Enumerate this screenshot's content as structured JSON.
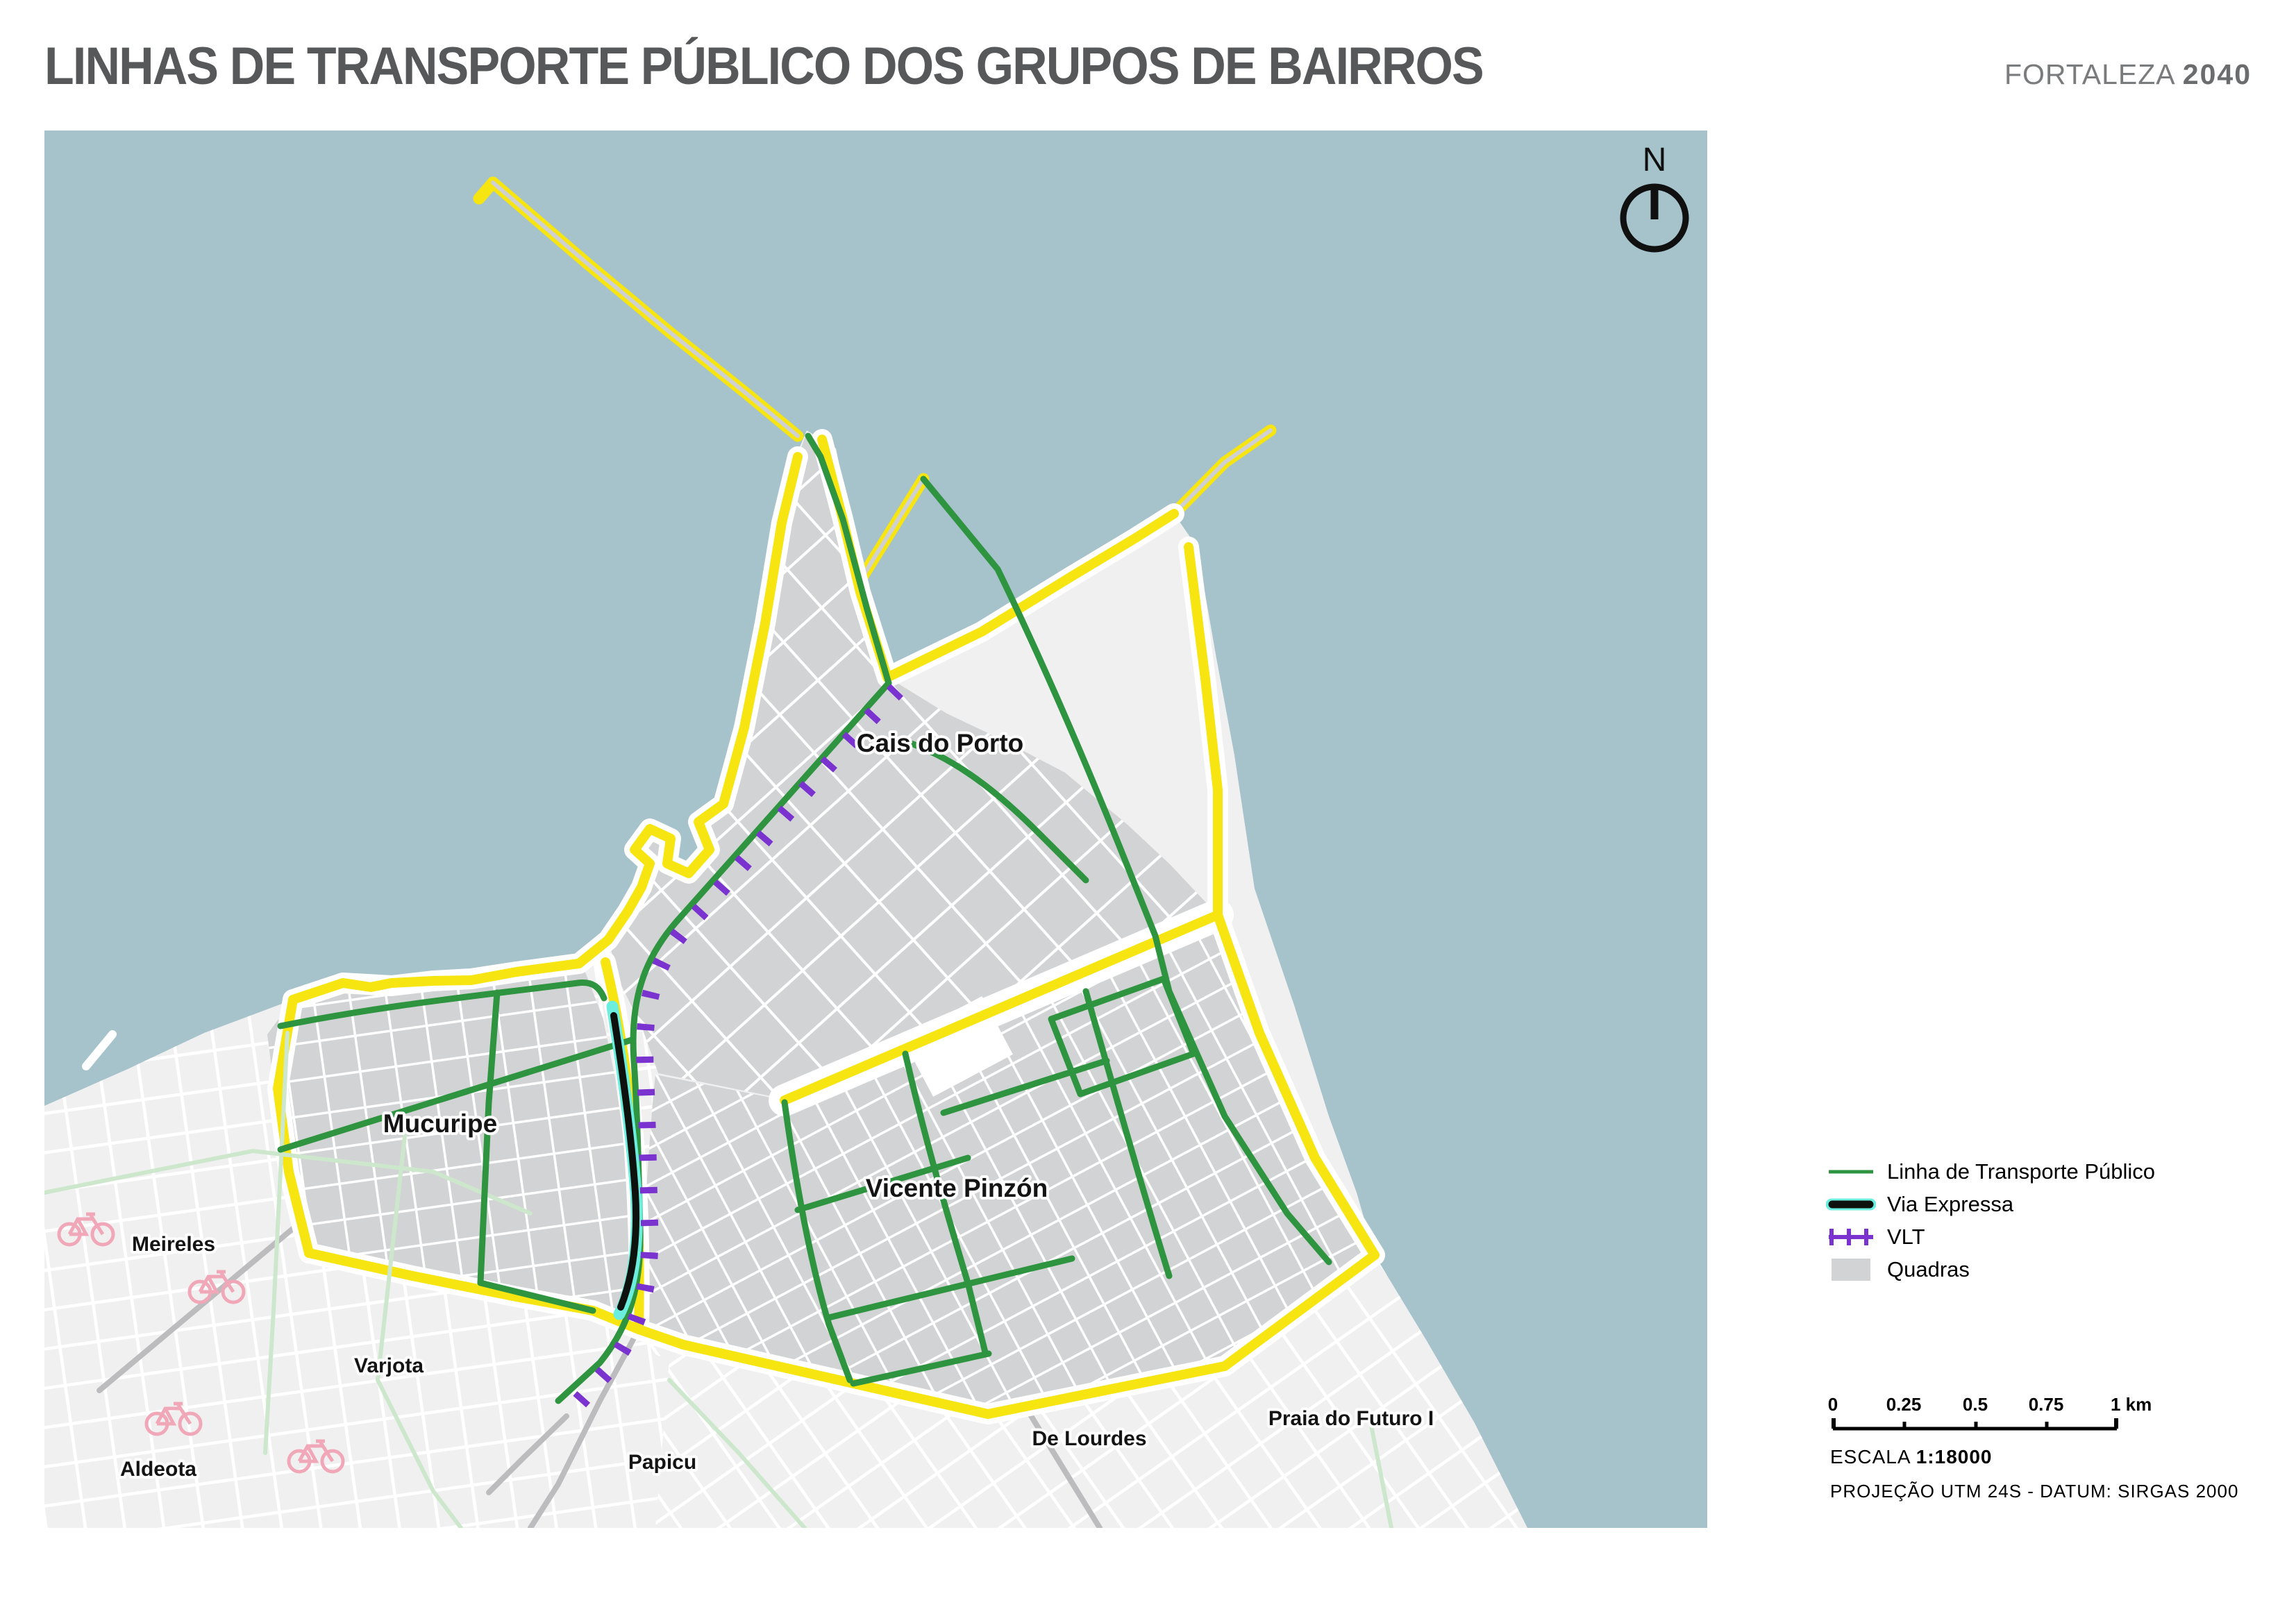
{
  "header": {
    "title": "LINHAS DE TRANSPORTE PÚBLICO DOS GRUPOS DE BAIRROS",
    "brand": "FORTALEZA",
    "brand_year": "2040"
  },
  "map": {
    "north_label": "N",
    "labels": {
      "cais_do_porto": "Cais do Porto",
      "mucuripe": "Mucuripe",
      "vicente_pinzon": "Vicente Pinzón",
      "meireles": "Meireles",
      "varjota": "Varjota",
      "aldeota": "Aldeota",
      "papicu": "Papicu",
      "de_lourdes": "De Lourdes",
      "praia_do_futuro": "Praia do Futuro I"
    },
    "colors": {
      "water": "#a6c2ca",
      "outside_land": "#f0f0f1",
      "quadras": "#d2d3d4",
      "street": "#ffffff",
      "boundary": "#f7e511",
      "transit_line": "#2e9440",
      "via_expressa_core": "#0d120e",
      "via_expressa_casing": "#6ceede",
      "vlt": "#7b33cf",
      "bike_lane": "#cde7cc",
      "bike_icon": "#f0a8b8",
      "road_gray": "#bcbcbe"
    }
  },
  "legend": {
    "items": [
      {
        "label": "Linha de Transporte Público",
        "type": "line",
        "color": "#2e9440"
      },
      {
        "label": "Via Expressa",
        "type": "line-cased",
        "color": "#0d120e",
        "casing": "#6ceede"
      },
      {
        "label": "VLT",
        "type": "line-ticked",
        "color": "#7b33cf"
      },
      {
        "label": "Quadras",
        "type": "swatch",
        "color": "#d2d3d4"
      }
    ]
  },
  "scalebar": {
    "ticks": [
      "0",
      "0.25",
      "0.5",
      "0.75",
      "1 km"
    ],
    "escala_label": "ESCALA",
    "escala_value": "1:18000",
    "projection": "PROJEÇÃO UTM 24S - DATUM: SIRGAS 2000"
  }
}
